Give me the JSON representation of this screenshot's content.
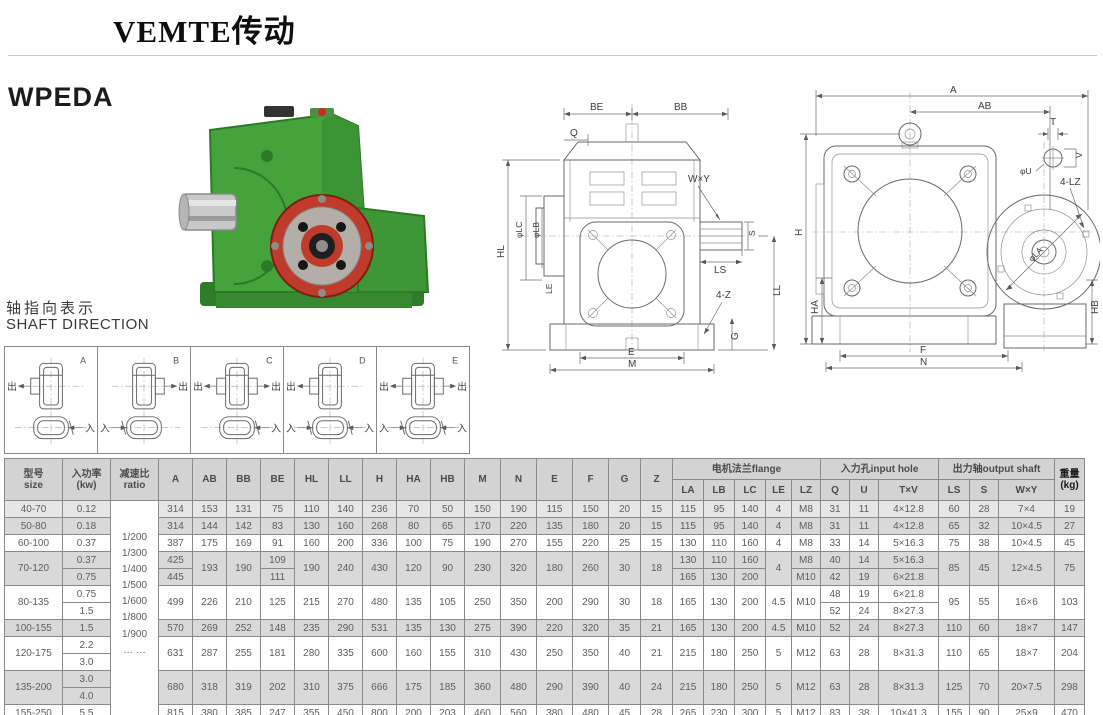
{
  "page": {
    "brand": "VEMTE传动",
    "model": "WPEDA"
  },
  "shaft_direction": {
    "title_zh": "轴指向表示",
    "title_en": "SHAFT DIRECTION",
    "out_char": "出",
    "in_char": "入",
    "cells": [
      {
        "label": "A",
        "out": [
          "left"
        ],
        "in": [
          "right"
        ]
      },
      {
        "label": "B",
        "out": [
          "right"
        ],
        "in": [
          "left"
        ]
      },
      {
        "label": "C",
        "out": [
          "left",
          "right"
        ],
        "in": [
          "right"
        ]
      },
      {
        "label": "D",
        "out": [
          "left"
        ],
        "in": [
          "left",
          "right"
        ]
      },
      {
        "label": "E",
        "out": [
          "left",
          "right"
        ],
        "in": [
          "left",
          "right"
        ]
      }
    ]
  },
  "drawings": {
    "front": {
      "be": "BE",
      "bb": "BB",
      "q": "Q",
      "wxy": "W×Y",
      "lc": "φLC",
      "lb": "φLB",
      "ls": "LS",
      "s": "S",
      "hl": "HL",
      "le": "LE",
      "z4": "4-Z",
      "g": "G",
      "ll": "LL",
      "e": "E",
      "m": "M"
    },
    "side": {
      "a": "A",
      "ab": "AB",
      "t": "T",
      "v": "V",
      "u": "φU",
      "lz4": "4-LZ",
      "la": "φLA",
      "h": "H",
      "ha": "HA",
      "hb": "HB",
      "f": "F",
      "n": "N"
    }
  },
  "table": {
    "header": [
      [
        {
          "t": "型号\nsize",
          "rs": 2
        },
        {
          "t": "入功率\n(kw)",
          "rs": 2
        },
        {
          "t": "减速比\nratio",
          "rs": 2
        },
        {
          "t": "A",
          "rs": 2
        },
        {
          "t": "AB",
          "rs": 2
        },
        {
          "t": "BB",
          "rs": 2
        },
        {
          "t": "BE",
          "rs": 2
        },
        {
          "t": "HL",
          "rs": 2
        },
        {
          "t": "LL",
          "rs": 2
        },
        {
          "t": "H",
          "rs": 2
        },
        {
          "t": "HA",
          "rs": 2
        },
        {
          "t": "HB",
          "rs": 2
        },
        {
          "t": "M",
          "rs": 2
        },
        {
          "t": "N",
          "rs": 2
        },
        {
          "t": "E",
          "rs": 2
        },
        {
          "t": "F",
          "rs": 2
        },
        {
          "t": "G",
          "rs": 2
        },
        {
          "t": "Z",
          "rs": 2
        },
        {
          "t": "电机法兰flange",
          "cs": 5
        },
        {
          "t": "入力孔input hole",
          "cs": 3
        },
        {
          "t": "出力轴output shaft",
          "cs": 3
        },
        {
          "t": "重量\n(kg)",
          "rs": 2,
          "c": "bold-dark"
        }
      ],
      [
        {
          "t": "LA"
        },
        {
          "t": "LB"
        },
        {
          "t": "LC"
        },
        {
          "t": "LE"
        },
        {
          "t": "LZ"
        },
        {
          "t": "Q"
        },
        {
          "t": "U"
        },
        {
          "t": "T×V"
        },
        {
          "t": "LS"
        },
        {
          "t": "S"
        },
        {
          "t": "W×Y"
        }
      ]
    ],
    "shades": [
      "g1",
      "g2",
      "w",
      "g2",
      "g2",
      "w",
      "w",
      "g2",
      "w",
      "w",
      "g2",
      "g2",
      "w"
    ],
    "rows": [
      [
        "40-70",
        "0.12",
        {
          "t": "1/200\n1/300\n1/400\n1/500\n1/600\n1/800\n1/900\n… …",
          "rs": 13,
          "c": "ratio"
        },
        "314",
        "153",
        "131",
        "75",
        "110",
        "140",
        "236",
        "70",
        "50",
        "150",
        "190",
        "115",
        "150",
        "20",
        "15",
        "115",
        "95",
        "140",
        "4",
        "M8",
        "31",
        "11",
        "4×12.8",
        "60",
        "28",
        "7×4",
        "19"
      ],
      [
        "50-80",
        "0.18",
        "314",
        "144",
        "142",
        "83",
        "130",
        "160",
        "268",
        "80",
        "65",
        "170",
        "220",
        "135",
        "180",
        "20",
        "15",
        "115",
        "95",
        "140",
        "4",
        "M8",
        "31",
        "11",
        "4×12.8",
        "65",
        "32",
        "10×4.5",
        "27"
      ],
      [
        "60-100",
        "0.37",
        "387",
        "175",
        "169",
        "91",
        "160",
        "200",
        "336",
        "100",
        "75",
        "190",
        "270",
        "155",
        "220",
        "25",
        "15",
        "130",
        "110",
        "160",
        "4",
        "M8",
        "33",
        "14",
        "5×16.3",
        "75",
        "38",
        "10×4.5",
        "45"
      ],
      [
        {
          "t": "70-120",
          "rs": 2
        },
        "0.37",
        "425",
        {
          "t": "193",
          "rs": 2
        },
        {
          "t": "190",
          "rs": 2
        },
        "109",
        {
          "t": "190",
          "rs": 2
        },
        {
          "t": "240",
          "rs": 2
        },
        {
          "t": "430",
          "rs": 2
        },
        {
          "t": "120",
          "rs": 2
        },
        {
          "t": "90",
          "rs": 2
        },
        {
          "t": "230",
          "rs": 2
        },
        {
          "t": "320",
          "rs": 2
        },
        {
          "t": "180",
          "rs": 2
        },
        {
          "t": "260",
          "rs": 2
        },
        {
          "t": "30",
          "rs": 2
        },
        {
          "t": "18",
          "rs": 2
        },
        "130",
        "110",
        "160",
        {
          "t": "4",
          "rs": 2
        },
        "M8",
        "40",
        "14",
        "5×16.3",
        {
          "t": "85",
          "rs": 2
        },
        {
          "t": "45",
          "rs": 2
        },
        {
          "t": "12×4.5",
          "rs": 2
        },
        {
          "t": "75",
          "rs": 2
        }
      ],
      [
        "0.75",
        "445",
        "111",
        "165",
        "130",
        "200",
        "M10",
        "42",
        "19",
        "6×21.8"
      ],
      [
        {
          "t": "80-135",
          "rs": 2
        },
        "0.75",
        {
          "t": "499",
          "rs": 2
        },
        {
          "t": "226",
          "rs": 2
        },
        {
          "t": "210",
          "rs": 2
        },
        {
          "t": "125",
          "rs": 2
        },
        {
          "t": "215",
          "rs": 2
        },
        {
          "t": "270",
          "rs": 2
        },
        {
          "t": "480",
          "rs": 2
        },
        {
          "t": "135",
          "rs": 2
        },
        {
          "t": "105",
          "rs": 2
        },
        {
          "t": "250",
          "rs": 2
        },
        {
          "t": "350",
          "rs": 2
        },
        {
          "t": "200",
          "rs": 2
        },
        {
          "t": "290",
          "rs": 2
        },
        {
          "t": "30",
          "rs": 2
        },
        {
          "t": "18",
          "rs": 2
        },
        {
          "t": "165",
          "rs": 2
        },
        {
          "t": "130",
          "rs": 2
        },
        {
          "t": "200",
          "rs": 2
        },
        {
          "t": "4.5",
          "rs": 2
        },
        {
          "t": "M10",
          "rs": 2
        },
        "48",
        "19",
        "6×21.8",
        {
          "t": "95",
          "rs": 2
        },
        {
          "t": "55",
          "rs": 2
        },
        {
          "t": "16×6",
          "rs": 2
        },
        {
          "t": "103",
          "rs": 2
        }
      ],
      [
        "1.5",
        "52",
        "24",
        "8×27.3"
      ],
      [
        "100-155",
        "1.5",
        "570",
        "269",
        "252",
        "148",
        "235",
        "290",
        "531",
        "135",
        "130",
        "275",
        "390",
        "220",
        "320",
        "35",
        "21",
        "165",
        "130",
        "200",
        "4.5",
        "M10",
        "52",
        "24",
        "8×27.3",
        "110",
        "60",
        "18×7",
        "147"
      ],
      [
        {
          "t": "120-175",
          "rs": 2
        },
        "2.2",
        {
          "t": "631",
          "rs": 2
        },
        {
          "t": "287",
          "rs": 2
        },
        {
          "t": "255",
          "rs": 2
        },
        {
          "t": "181",
          "rs": 2
        },
        {
          "t": "280",
          "rs": 2
        },
        {
          "t": "335",
          "rs": 2
        },
        {
          "t": "600",
          "rs": 2
        },
        {
          "t": "160",
          "rs": 2
        },
        {
          "t": "155",
          "rs": 2
        },
        {
          "t": "310",
          "rs": 2
        },
        {
          "t": "430",
          "rs": 2
        },
        {
          "t": "250",
          "rs": 2
        },
        {
          "t": "350",
          "rs": 2
        },
        {
          "t": "40",
          "rs": 2
        },
        {
          "t": "21",
          "rs": 2
        },
        {
          "t": "215",
          "rs": 2
        },
        {
          "t": "180",
          "rs": 2
        },
        {
          "t": "250",
          "rs": 2
        },
        {
          "t": "5",
          "rs": 2
        },
        {
          "t": "M12",
          "rs": 2
        },
        {
          "t": "63",
          "rs": 2
        },
        {
          "t": "28",
          "rs": 2
        },
        {
          "t": "8×31.3",
          "rs": 2
        },
        {
          "t": "110",
          "rs": 2
        },
        {
          "t": "65",
          "rs": 2
        },
        {
          "t": "18×7",
          "rs": 2
        },
        {
          "t": "204",
          "rs": 2
        }
      ],
      [
        "3.0"
      ],
      [
        {
          "t": "135-200",
          "rs": 2
        },
        "3.0",
        {
          "t": "680",
          "rs": 2
        },
        {
          "t": "318",
          "rs": 2
        },
        {
          "t": "319",
          "rs": 2
        },
        {
          "t": "202",
          "rs": 2
        },
        {
          "t": "310",
          "rs": 2
        },
        {
          "t": "375",
          "rs": 2
        },
        {
          "t": "666",
          "rs": 2
        },
        {
          "t": "175",
          "rs": 2
        },
        {
          "t": "185",
          "rs": 2
        },
        {
          "t": "360",
          "rs": 2
        },
        {
          "t": "480",
          "rs": 2
        },
        {
          "t": "290",
          "rs": 2
        },
        {
          "t": "390",
          "rs": 2
        },
        {
          "t": "40",
          "rs": 2
        },
        {
          "t": "24",
          "rs": 2
        },
        {
          "t": "215",
          "rs": 2
        },
        {
          "t": "180",
          "rs": 2
        },
        {
          "t": "250",
          "rs": 2
        },
        {
          "t": "5",
          "rs": 2
        },
        {
          "t": "M12",
          "rs": 2
        },
        {
          "t": "63",
          "rs": 2
        },
        {
          "t": "28",
          "rs": 2
        },
        {
          "t": "8×31.3",
          "rs": 2
        },
        {
          "t": "125",
          "rs": 2
        },
        {
          "t": "70",
          "rs": 2
        },
        {
          "t": "20×7.5",
          "rs": 2
        },
        {
          "t": "298",
          "rs": 2
        }
      ],
      [
        "4.0"
      ],
      [
        "155-250",
        "5.5",
        "815",
        "380",
        "385",
        "247",
        "355",
        "450",
        "800",
        "200",
        "203",
        "460",
        "560",
        "380",
        "480",
        "45",
        "28",
        "265",
        "230",
        "300",
        "5",
        "M12",
        "83",
        "38",
        "10×41.3",
        "155",
        "90",
        "25×9",
        "470"
      ]
    ]
  }
}
